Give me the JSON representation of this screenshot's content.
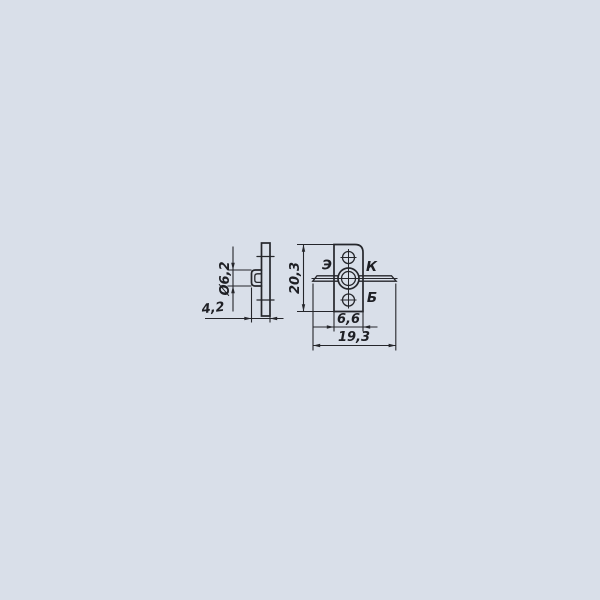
{
  "side_view": {
    "dim_diameter": "Ø6,2",
    "dim_depth": "4,2"
  },
  "front_view": {
    "dim_height": "20,3",
    "dim_body_width": "6,6",
    "dim_overall_width": "19,3",
    "pin_emitter": "Э",
    "pin_collector": "К",
    "pin_base": "Б"
  },
  "colors": {
    "background": "#d9dfe9",
    "ink": "#25262b"
  }
}
